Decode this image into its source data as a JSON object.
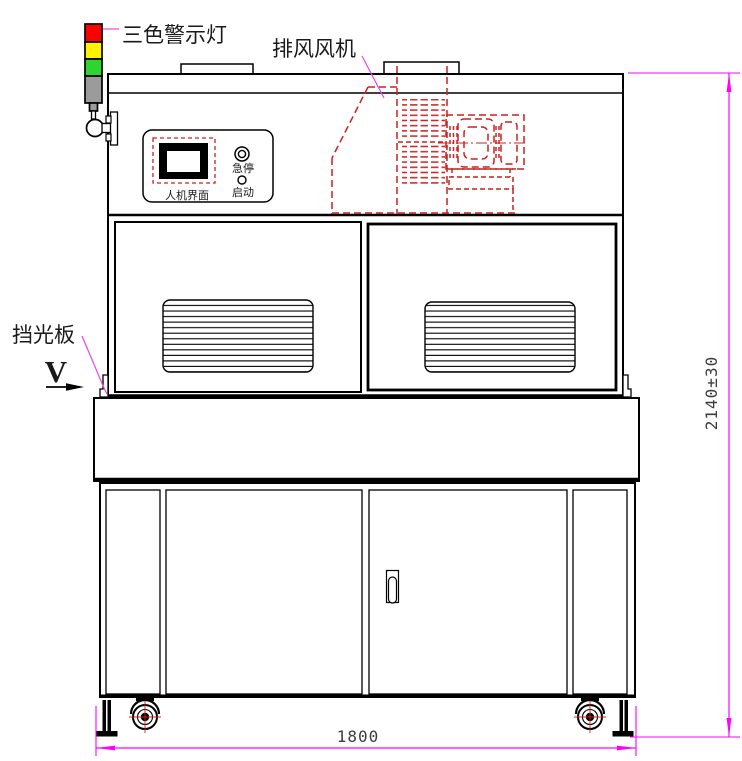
{
  "labels": {
    "warning_light": "三色警示灯",
    "exhaust_fan": "排风风机",
    "light_shield": "挡光板",
    "hmi_screen": "人机界面",
    "emergency_stop": "急停",
    "start": "启动",
    "view_marker": "V"
  },
  "dimensions": {
    "overall_width": "1800",
    "overall_height": "2140±30"
  },
  "colors": {
    "outline_black": "#000000",
    "hidden_line_red": "#CC2020",
    "dimension_magenta": "#FF00FF",
    "leader_magenta": "#E648E6",
    "lamp_red": "#FF0000",
    "lamp_yellow": "#FFF100",
    "lamp_green": "#2FD52F",
    "lamp_gray": "#9B9B9B",
    "dimension_text": "#3D3D3D"
  }
}
